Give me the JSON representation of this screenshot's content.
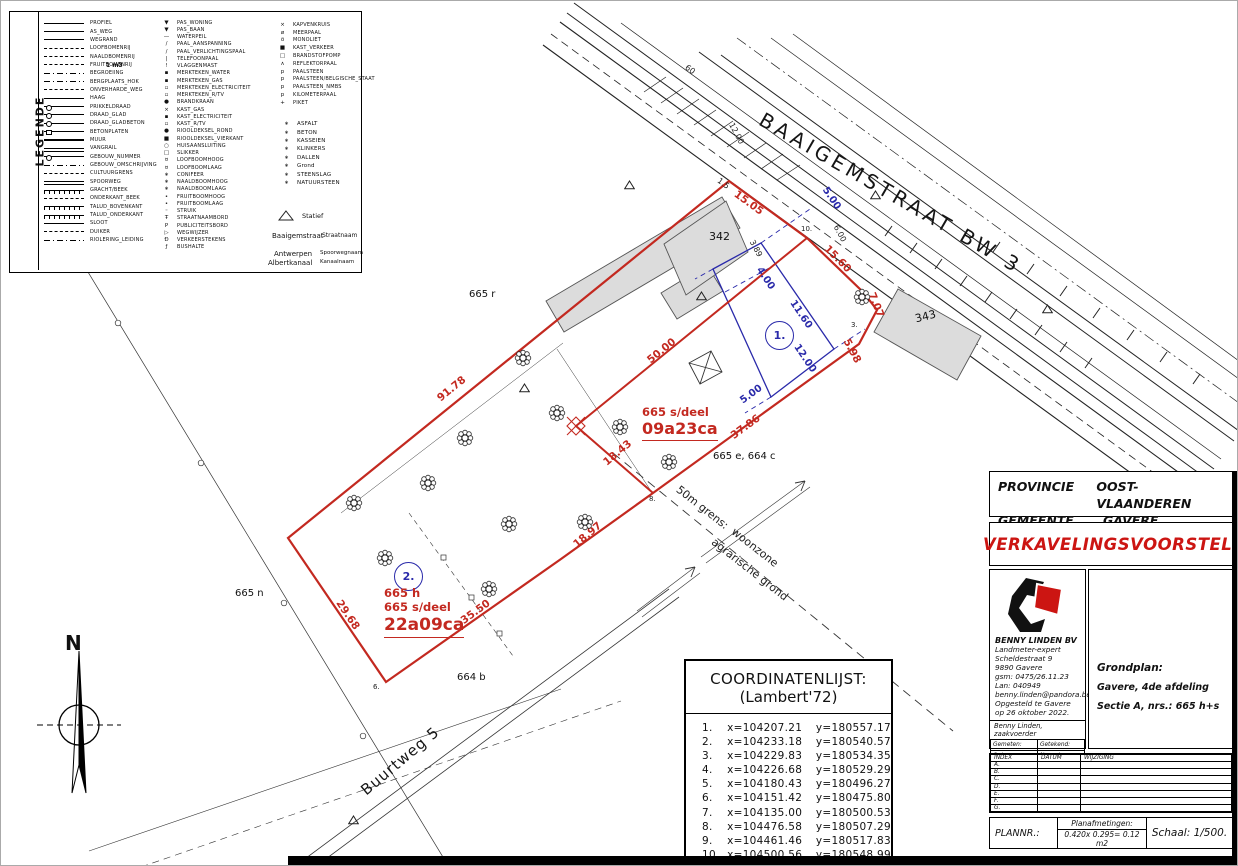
{
  "colors": {
    "red": "#c32920",
    "blue": "#2a2aaa",
    "doc_red": "#cc1512",
    "building_fill": "#dcdcdc"
  },
  "legend": {
    "title": "LEGENDE",
    "note": "1 m3",
    "col1": [
      {
        "sym": "solid",
        "label": "PROFIEL"
      },
      {
        "sym": "solid",
        "label": "AS_WEG"
      },
      {
        "sym": "solid",
        "label": "WEGRAND"
      },
      {
        "sym": "dash",
        "label": "LOOFBOMENRIJ"
      },
      {
        "sym": "dash",
        "label": "NAALDBOMENRIJ"
      },
      {
        "sym": "dash",
        "label": "FRUITBOMENRIJ"
      },
      {
        "sym": "dashdot",
        "label": "BEGROEIING"
      },
      {
        "sym": "dashdot",
        "label": "BERGPLAATS_HOK"
      },
      {
        "sym": "dash",
        "label": "ONVERHARDE_WEG"
      },
      {
        "sym": "solid",
        "label": "HAAG"
      },
      {
        "sym": "circ",
        "label": "PRIKKELDRAAD"
      },
      {
        "sym": "circ",
        "label": "DRAAD_GLAD"
      },
      {
        "sym": "circ",
        "label": "DRAAD_GLADBETON"
      },
      {
        "sym": "sq",
        "label": "BETONPLATEN"
      },
      {
        "sym": "thick",
        "label": "MUUR"
      },
      {
        "sym": "double",
        "label": "VANGRAIL"
      },
      {
        "sym": "circ",
        "label": "GEBOUW_NUMMER"
      },
      {
        "sym": "dashdot",
        "label": "GEBOUW_OMSCHRIJVING"
      },
      {
        "sym": "dash",
        "label": "CULTUURGRENS"
      },
      {
        "sym": "double",
        "label": "SPOORWEG"
      },
      {
        "sym": "comb",
        "label": "GRACHT/BEEK"
      },
      {
        "sym": "dash",
        "label": "ONDERKANT_BEEK"
      },
      {
        "sym": "comb",
        "label": "TALUD_BOVENKANT"
      },
      {
        "sym": "comb",
        "label": "TALUD_ONDERKANT"
      },
      {
        "sym": "solid",
        "label": "SLOOT"
      },
      {
        "sym": "dash",
        "label": "DUIKER"
      },
      {
        "sym": "dashdot",
        "label": "RIOLERING_LEIDING"
      }
    ],
    "col2": [
      {
        "sym": "▼",
        "label": "PAS_WONING"
      },
      {
        "sym": "▼",
        "label": "PAS_BAAN"
      },
      {
        "sym": "—",
        "label": "WATERPEIL"
      },
      {
        "sym": "/",
        "label": "PAAL_AANSPANNING"
      },
      {
        "sym": "/",
        "label": "PAAL_VERLICHTINGSPAAL"
      },
      {
        "sym": "|",
        "label": "TELEFOONPAAL"
      },
      {
        "sym": "!",
        "label": "VLAGGENMAST"
      },
      {
        "sym": "▪",
        "label": "MERKTEKEN_WATER"
      },
      {
        "sym": "▪",
        "label": "MERKTEKEN_GAS"
      },
      {
        "sym": "▫",
        "label": "MERKTEKEN_ELECTRICITEIT"
      },
      {
        "sym": "▫",
        "label": "MERKTEKEN_R/TV"
      },
      {
        "sym": "●",
        "label": "BRANDKRAAN"
      },
      {
        "sym": "×",
        "label": "KAST_GAS"
      },
      {
        "sym": "▪",
        "label": "KAST_ELECTRICITEIT"
      },
      {
        "sym": "▫",
        "label": "KAST_R/TV"
      },
      {
        "sym": "●",
        "label": "RIOOLDEKSEL_ROND"
      },
      {
        "sym": "■",
        "label": "RIOOLDEKSEL_VIERKANT"
      },
      {
        "sym": "○",
        "label": "HUISAANSLUITING"
      },
      {
        "sym": "□",
        "label": "SLIKKER"
      },
      {
        "sym": "¤",
        "label": "LOOFBOOMHOOG"
      },
      {
        "sym": "¤",
        "label": "LOOFBOOMLAAG"
      },
      {
        "sym": "∗",
        "label": "CONIFEER"
      },
      {
        "sym": "∗",
        "label": "NAALDBOOMHOOG"
      },
      {
        "sym": "∗",
        "label": "NAALDBOOMLAAG"
      },
      {
        "sym": "•",
        "label": "FRUITBOOMHOOG"
      },
      {
        "sym": "•",
        "label": "FRUITBOOMLAAG"
      },
      {
        "sym": "◦",
        "label": "STRUIK"
      },
      {
        "sym": "Ŧ",
        "label": "STRAATNAAMBORD"
      },
      {
        "sym": "P",
        "label": "PUBLICITEITSBORD"
      },
      {
        "sym": "▷",
        "label": "WEGWIJZER"
      },
      {
        "sym": "Ð",
        "label": "VERKEERSTEKENS"
      },
      {
        "sym": "ƒ",
        "label": "BUSHALTE"
      }
    ],
    "col3": [
      {
        "sym": "×",
        "label": "KAPVENKRUIS"
      },
      {
        "sym": "ø",
        "label": "MEERPAAL"
      },
      {
        "sym": "ö",
        "label": "MONOLIET"
      },
      {
        "sym": "■",
        "label": "KAST_VERKEER"
      },
      {
        "sym": "□",
        "label": "BRANDSTOFPOMP"
      },
      {
        "sym": "∧",
        "label": "REFLEKTORPAAL"
      },
      {
        "sym": "p",
        "label": "PAALSTEEN"
      },
      {
        "sym": "p",
        "label": "PAALSTEEN/BELGISCHE_STAAT"
      },
      {
        "sym": "p",
        "label": "PAALSTEEN_NMBS"
      },
      {
        "sym": "p",
        "label": "KILOMETERPAAL"
      },
      {
        "sym": "+",
        "label": "PIKET"
      }
    ],
    "materials": [
      {
        "sym": "∗",
        "label": "ASFALT"
      },
      {
        "sym": "∗",
        "label": "BETON"
      },
      {
        "sym": "∗",
        "label": "KASSEIEN"
      },
      {
        "sym": "∗",
        "label": "KLINKERS"
      },
      {
        "sym": "∗",
        "label": "DALLEN"
      },
      {
        "sym": "∗",
        "label": "Grond"
      },
      {
        "sym": "∗",
        "label": "STEENSLAG"
      },
      {
        "sym": "∗",
        "label": "NATUURSTEEN"
      }
    ],
    "examples": {
      "statief_label": "Statief",
      "straat_sample": "Baaigemstraat",
      "straat_label": "Straatnaam",
      "kanaal_sample1": "Antwerpen",
      "kanaal_sample2": "Albertkanaal",
      "kanaal_label1": "Spoorwegnaam",
      "kanaal_label2": "Kanaalnaam"
    }
  },
  "north": {
    "label": "N"
  },
  "plan": {
    "street_label": "BAAIGEMSTRAAT  BW  3",
    "road_label": "Buurtweg 5",
    "lot1": {
      "no": "1.",
      "line1": "665 s/deel",
      "area": "09a23ca"
    },
    "lot2": {
      "no": "2.",
      "line1": "665 h",
      "line2": "665 s/deel",
      "area": "22a09ca"
    },
    "parcel_labels": [
      {
        "t": "342",
        "css": "left:708px;top:229px;font-size:11px"
      },
      {
        "t": "343",
        "css": "left:914px;top:309px;font-size:11px;transform:rotate(-14deg)"
      },
      {
        "t": "665 r",
        "css": "left:468px;top:288px"
      },
      {
        "t": "665 n",
        "css": "left:234px;top:587px"
      },
      {
        "t": "664 b",
        "css": "left:456px;top:671px"
      },
      {
        "t": "665 e, 664 c",
        "css": "left:712px;top:450px"
      }
    ],
    "red_dims": [
      {
        "t": "15.05",
        "css": "left:731px;top:196px;transform:rotate(36deg)"
      },
      {
        "t": "15.60",
        "css": "left:820px;top:252px;transform:rotate(45deg)"
      },
      {
        "t": "7.07",
        "css": "left:862px;top:298px;transform:rotate(68deg)"
      },
      {
        "t": "5.98",
        "css": "left:838px;top:344px;transform:rotate(62deg)"
      },
      {
        "t": "37.86",
        "css": "left:728px;top:420px;transform:rotate(-36deg)"
      },
      {
        "t": "18.43",
        "css": "left:600px;top:446px;transform:rotate(-40deg)"
      },
      {
        "t": "50.00",
        "css": "left:644px;top:344px;transform:rotate(-39deg)"
      },
      {
        "t": "91.78",
        "css": "left:434px;top:382px;transform:rotate(-39deg)"
      },
      {
        "t": "18.97",
        "css": "left:570px;top:528px;transform:rotate(-40deg)"
      },
      {
        "t": "35.50",
        "css": "left:458px;top:605px;transform:rotate(-36deg)"
      },
      {
        "t": "29.68",
        "css": "left:330px;top:608px;transform:rotate(56deg)"
      }
    ],
    "blue_dims": [
      {
        "t": "4.00",
        "css": "left:752px;top:272px;transform:rotate(56deg)"
      },
      {
        "t": "11.60",
        "css": "left:784px;top:308px;transform:rotate(56deg)"
      },
      {
        "t": "12.00",
        "css": "left:788px;top:352px;transform:rotate(56deg)"
      },
      {
        "t": "5.00",
        "css": "left:738px;top:388px;transform:rotate(-36deg)"
      },
      {
        "t": "5.00",
        "css": "left:818px;top:192px;transform:rotate(56deg)"
      }
    ],
    "black_dims": [
      {
        "t": "12.00",
        "css": "left:724px;top:128px;transform:rotate(62deg)"
      },
      {
        "t": "6.00",
        "css": "left:830px;top:228px;transform:rotate(62deg)"
      },
      {
        "t": "3.89",
        "css": "left:746px;top:243px;transform:rotate(62deg)"
      },
      {
        "t": "1.5",
        "css": "left:716px;top:178px;transform:rotate(36deg)"
      },
      {
        "t": "60",
        "css": "left:684px;top:64px;transform:rotate(36deg)"
      }
    ],
    "point_labels": [
      {
        "t": "10.",
        "css": "left:800px;top:224px"
      },
      {
        "t": "8.",
        "css": "left:648px;top:494px"
      },
      {
        "t": "6.",
        "css": "left:372px;top:682px"
      },
      {
        "t": "3.",
        "css": "left:850px;top:320px"
      }
    ],
    "zone_labels": [
      {
        "t": "50m grens:",
        "css": "left:670px;top:500px;transform:rotate(38deg)"
      },
      {
        "t": "woonzone",
        "css": "left:726px;top:540px;transform:rotate(38deg)"
      },
      {
        "t": "agrarische grond",
        "css": "left:702px;top:562px;transform:rotate(38deg)"
      }
    ],
    "trees": [
      {
        "css": "left:513px;top:348px"
      },
      {
        "css": "left:547px;top:403px"
      },
      {
        "css": "left:455px;top:428px"
      },
      {
        "css": "left:418px;top:473px"
      },
      {
        "css": "left:344px;top:493px"
      },
      {
        "css": "left:499px;top:514px"
      },
      {
        "css": "left:575px;top:512px"
      },
      {
        "css": "left:659px;top:452px"
      },
      {
        "css": "left:610px;top:417px"
      },
      {
        "css": "left:852px;top:287px"
      },
      {
        "css": "left:479px;top:579px"
      },
      {
        "css": "left:375px;top:548px"
      }
    ],
    "triangles": [
      {
        "css": "left:623px;top:179px"
      },
      {
        "css": "left:869px;top:189px"
      },
      {
        "css": "left:695px;top:290px"
      },
      {
        "css": "left:518px;top:382px"
      },
      {
        "css": "left:347px;top:814px"
      },
      {
        "css": "left:1041px;top:303px"
      }
    ]
  },
  "coords": {
    "title": "COORDINATENLIJST:",
    "subtitle": "(Lambert'72)",
    "rows": [
      {
        "n": "1.",
        "x": "x=104207.21",
        "y": "y=180557.17"
      },
      {
        "n": "2.",
        "x": "x=104233.18",
        "y": "y=180540.57"
      },
      {
        "n": "3.",
        "x": "x=104229.83",
        "y": "y=180534.35"
      },
      {
        "n": "4.",
        "x": "x=104226.68",
        "y": "y=180529.29"
      },
      {
        "n": "5.",
        "x": "x=104180.43",
        "y": "y=180496.27"
      },
      {
        "n": "6.",
        "x": "x=104151.42",
        "y": "y=180475.80"
      },
      {
        "n": "7.",
        "x": "x=104135.00",
        "y": "y=180500.53"
      },
      {
        "n": "8.",
        "x": "x=104476.58",
        "y": "y=180507.29"
      },
      {
        "n": "9.",
        "x": "x=104461.46",
        "y": "y=180517.83"
      },
      {
        "n": "10.",
        "x": "x=104500.56",
        "y": "y=180548.99"
      }
    ]
  },
  "titleblock": {
    "provincie_label": "PROVINCIE",
    "provincie": "OOST-VLAANDEREN",
    "gemeente_label": "GEMEENTE",
    "gemeente": "GAVERE",
    "doc_title": "VERKAVELINGSVOORSTEL.",
    "company": {
      "name": "BENNY LINDEN BV",
      "lines": [
        "Landmeter-expert",
        "Scheldestraat 9",
        "9890 Gavere",
        "gsm: 0475/26.11.23",
        "Lan: 040949",
        "benny.linden@pandora.be",
        "Opgesteld te Gavere",
        "op 26 oktober 2022."
      ],
      "signer": "Benny Linden, zaakvoerder",
      "cells": [
        "Gemeten:",
        "Getekend:",
        "Ontwerp:",
        "Nagezien:"
      ]
    },
    "grondplan": {
      "title": "Grondplan:",
      "line1": "Gavere, 4de afdeling",
      "line2": "Sectie A, nrs.: 665 h+s"
    },
    "revisions": {
      "headers": [
        "INDEX",
        "DATUM",
        "WIJZIGING"
      ],
      "rows": [
        "A.",
        "B.",
        "C.",
        "D.",
        "E.",
        "F.",
        "G."
      ]
    },
    "plannr_label": "PLANNR.:",
    "afmetingen_label": "Planafmetingen:",
    "afmetingen_value": "0.420x 0.295= 0.12 m2",
    "schaal": "Schaal: 1/500."
  }
}
